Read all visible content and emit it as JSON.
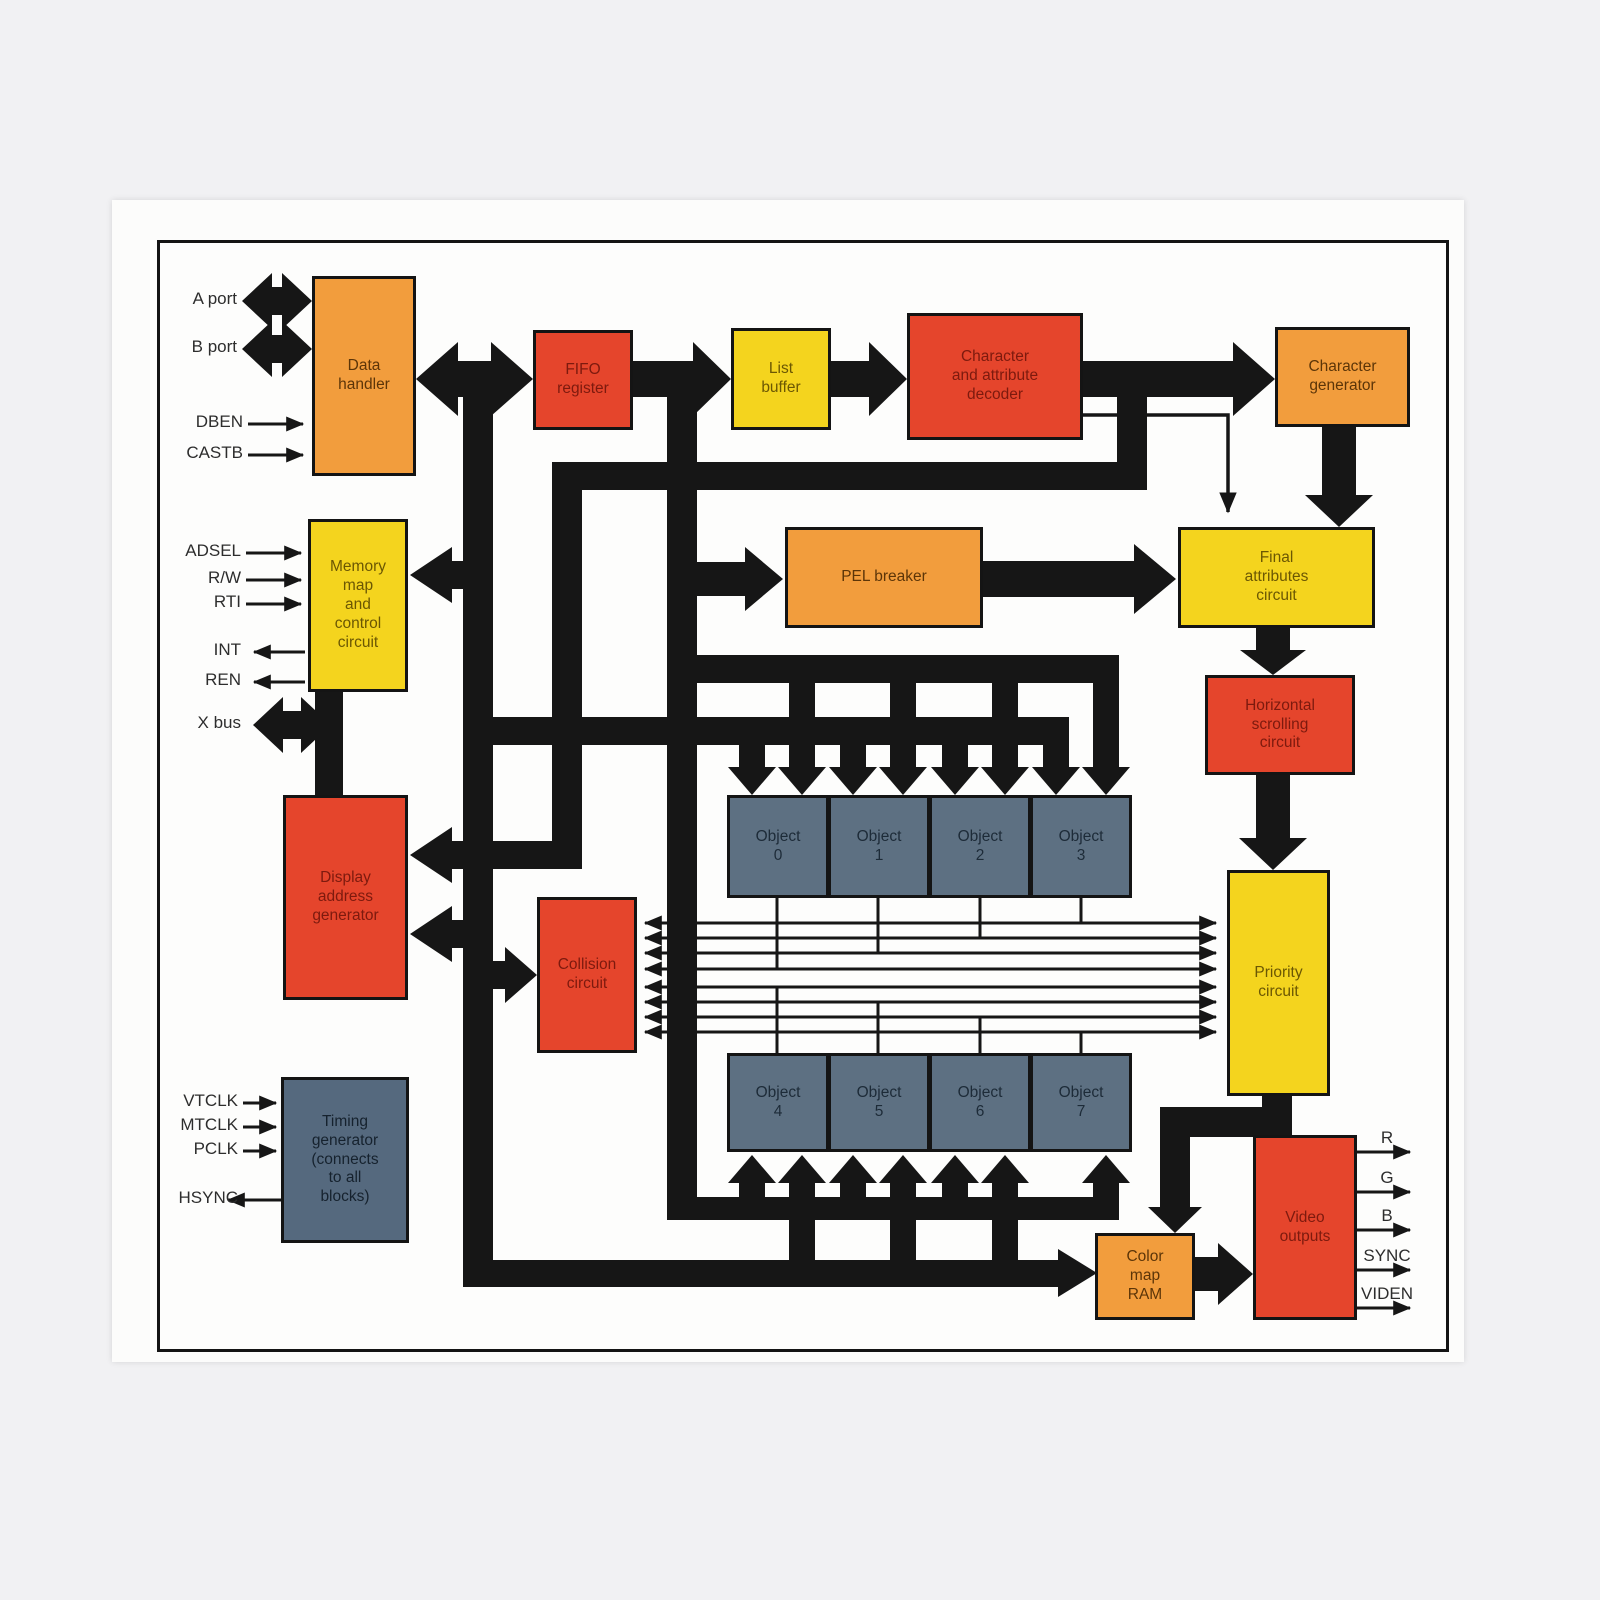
{
  "blocks": {
    "data_handler": {
      "label": "Data\nhandler"
    },
    "fifo_register": {
      "label": "FIFO\nregister"
    },
    "list_buffer": {
      "label": "List\nbuffer"
    },
    "char_decoder": {
      "label": "Character\nand attribute\ndecoder"
    },
    "char_generator": {
      "label": "Character\ngenerator"
    },
    "memory_map": {
      "label": "Memory\nmap\nand\ncontrol\ncircuit"
    },
    "pel_breaker": {
      "label": "PEL breaker"
    },
    "final_attributes": {
      "label": "Final\nattributes\ncircuit"
    },
    "h_scrolling": {
      "label": "Horizontal\nscrolling\ncircuit"
    },
    "display_addr": {
      "label": "Display\naddress\ngenerator"
    },
    "collision": {
      "label": "Collision\ncircuit"
    },
    "priority": {
      "label": "Priority\ncircuit"
    },
    "timing_gen": {
      "label": "Timing\ngenerator\n(connects\nto all\nblocks)"
    },
    "color_map_ram": {
      "label": "Color\nmap\nRAM"
    },
    "video_outputs": {
      "label": "Video\noutputs"
    },
    "objects": [
      {
        "label": "Object\n0"
      },
      {
        "label": "Object\n1"
      },
      {
        "label": "Object\n2"
      },
      {
        "label": "Object\n3"
      },
      {
        "label": "Object\n4"
      },
      {
        "label": "Object\n5"
      },
      {
        "label": "Object\n6"
      },
      {
        "label": "Object\n7"
      }
    ]
  },
  "io": {
    "a_port": "A port",
    "b_port": "B port",
    "dben": "DBEN",
    "castb": "CASTB",
    "adsel": "ADSEL",
    "rw": "R/W",
    "rti": "RTI",
    "int": "INT",
    "ren": "REN",
    "xbus": "X bus",
    "vtclk": "VTCLK",
    "mtclk": "MTCLK",
    "pclk": "PCLK",
    "hsync": "HSYNC",
    "r": "R",
    "g": "G",
    "b": "B",
    "sync": "SYNC",
    "viden": "VIDEN"
  },
  "colors": {
    "orange": "#F29D3D",
    "red": "#E5452C",
    "yellow": "#F4D41E",
    "slate": "#5D7082",
    "bus_black": "#161616",
    "page": "#fdfdfc"
  }
}
